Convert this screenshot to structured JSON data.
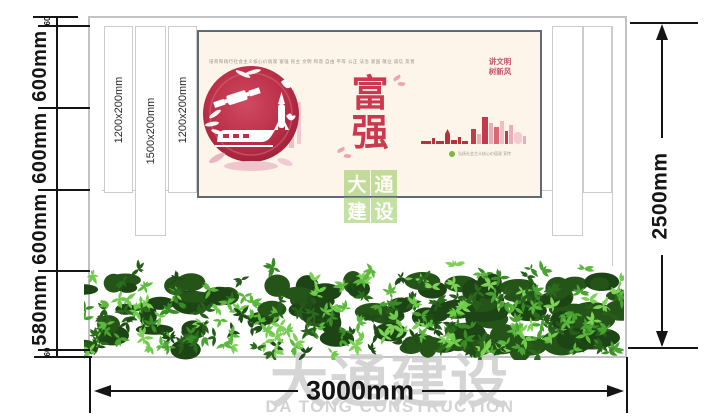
{
  "dimensions": {
    "left_chain": [
      "60",
      "600mm",
      "600mm",
      "600mm",
      "580mm",
      "60"
    ],
    "right_total": "2500mm",
    "bottom_total": "3000mm"
  },
  "panel_labels": [
    "1200x200mm",
    "1500x200mm",
    "1200x200mm"
  ],
  "poster": {
    "header_text": "培育和践行社会主义核心价值观  富强 民主 文明 和谐 自由 平等 公正 法治 爱国 敬业 诚信 友善",
    "slogan_line1": "讲文明",
    "slogan_line2": "树新风",
    "theme_char_top": "富",
    "theme_char_bottom": "强",
    "footnote_text": "弘扬社会主义核心价值观 宣传"
  },
  "watermarks": {
    "center_chars": [
      "大",
      "通",
      "建",
      "设"
    ],
    "bottom_cn": "大通建设",
    "bottom_en": "DA TONG CONSTRUCTION"
  },
  "colors": {
    "dimension_line": "#151515",
    "wall_line": "#cccccc",
    "poster_bg": "#fdf5ea",
    "poster_red": "#ce3750",
    "emblem_red": "#b02b42",
    "hedge_green": "#3a8a28",
    "watermark_green": "#8bc34a",
    "watermark_gray": "#cbcbcb"
  }
}
